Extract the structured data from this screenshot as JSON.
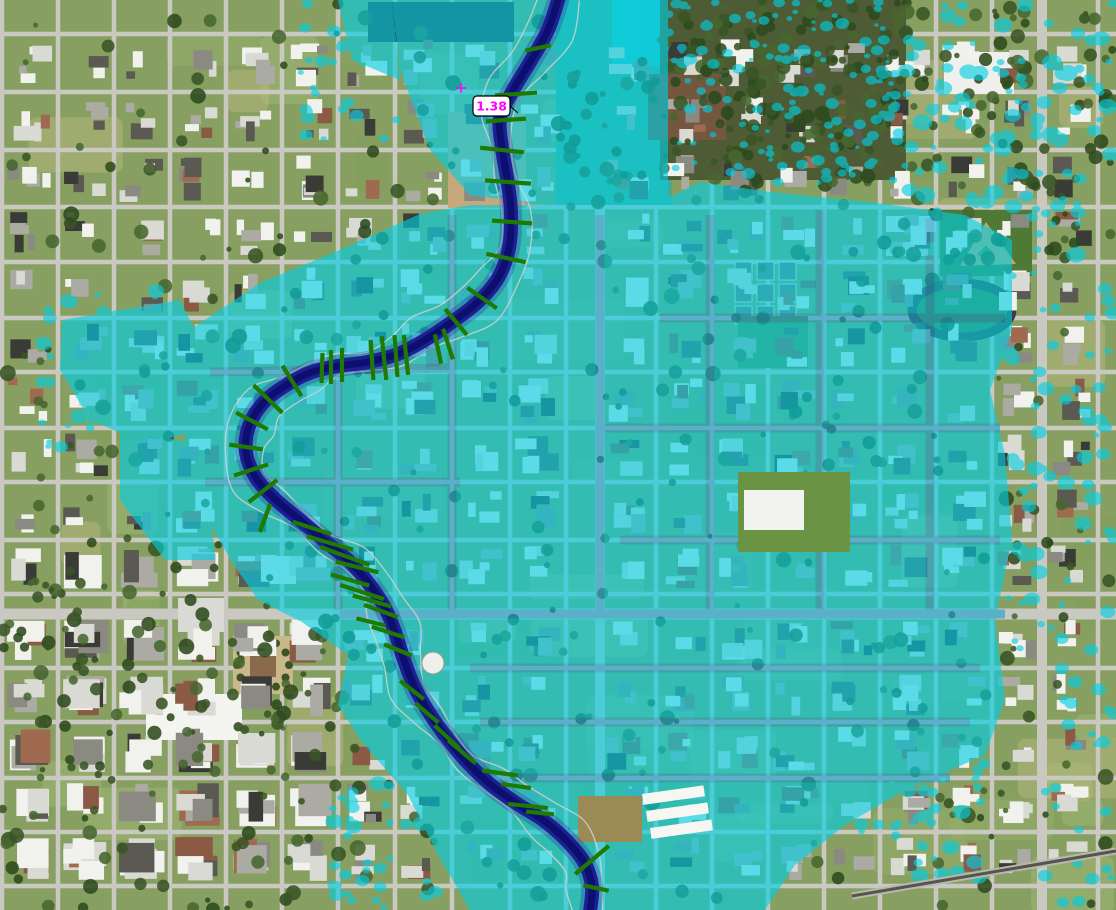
{
  "map": {
    "type": "flood-inundation-aerial-map",
    "station_label": {
      "text": "1.38",
      "x": 473,
      "y": 96,
      "w": 37,
      "h": 20,
      "text_color": "#FF00FF",
      "box_fill": "#FFFFFF",
      "box_border": "#000000"
    },
    "marker_cross": {
      "x": 461,
      "y": 88,
      "color": "#FF00FF"
    },
    "colors": {
      "flood": "#00CFE4",
      "flood_opacity": 0.62,
      "flood_street": "#17A0CE",
      "channel_outer": "#1D1F92",
      "channel_core": "#0D0F6E",
      "channel_glow": "#2A2AA0",
      "cross_section": "#1E7A02",
      "bank_line": "#D2D2CC",
      "ground": "#87A061",
      "street": "#C9C9C2",
      "railroad": "#55554D"
    },
    "river_path": [
      [
        560,
        -6
      ],
      [
        548,
        30
      ],
      [
        530,
        62
      ],
      [
        512,
        92
      ],
      [
        500,
        118
      ],
      [
        502,
        148
      ],
      [
        507,
        178
      ],
      [
        511,
        212
      ],
      [
        509,
        248
      ],
      [
        498,
        278
      ],
      [
        478,
        302
      ],
      [
        452,
        322
      ],
      [
        425,
        340
      ],
      [
        398,
        354
      ],
      [
        368,
        362
      ],
      [
        338,
        366
      ],
      [
        312,
        372
      ],
      [
        288,
        384
      ],
      [
        264,
        402
      ],
      [
        249,
        426
      ],
      [
        246,
        452
      ],
      [
        256,
        478
      ],
      [
        276,
        500
      ],
      [
        300,
        520
      ],
      [
        326,
        542
      ],
      [
        350,
        562
      ],
      [
        370,
        585
      ],
      [
        385,
        608
      ],
      [
        395,
        632
      ],
      [
        404,
        660
      ],
      [
        415,
        688
      ],
      [
        430,
        714
      ],
      [
        447,
        738
      ],
      [
        467,
        762
      ],
      [
        490,
        784
      ],
      [
        516,
        803
      ],
      [
        543,
        820
      ],
      [
        566,
        840
      ],
      [
        584,
        862
      ],
      [
        592,
        886
      ],
      [
        590,
        912
      ]
    ],
    "cross_sections": [
      [
        538,
        48,
        -12,
        26
      ],
      [
        516,
        94,
        -4,
        42
      ],
      [
        506,
        120,
        -4,
        40
      ],
      [
        502,
        150,
        6,
        44
      ],
      [
        508,
        182,
        4,
        46
      ],
      [
        512,
        222,
        4,
        40
      ],
      [
        506,
        258,
        12,
        40
      ],
      [
        482,
        298,
        35,
        36
      ],
      [
        456,
        322,
        50,
        34
      ],
      [
        448,
        344,
        72,
        32
      ],
      [
        438,
        349,
        78,
        30
      ],
      [
        406,
        355,
        84,
        40
      ],
      [
        396,
        356,
        86,
        42
      ],
      [
        384,
        358,
        84,
        44
      ],
      [
        372,
        360,
        86,
        40
      ],
      [
        342,
        365,
        90,
        34
      ],
      [
        331,
        367,
        90,
        34
      ],
      [
        322,
        368,
        92,
        30
      ],
      [
        292,
        381,
        58,
        36
      ],
      [
        268,
        399,
        44,
        40
      ],
      [
        252,
        421,
        28,
        36
      ],
      [
        246,
        447,
        8,
        34
      ],
      [
        251,
        470,
        -18,
        36
      ],
      [
        263,
        491,
        -38,
        36
      ],
      [
        265,
        518,
        -70,
        30
      ],
      [
        312,
        528,
        18,
        40
      ],
      [
        330,
        543,
        16,
        48
      ],
      [
        345,
        556,
        20,
        52
      ],
      [
        357,
        567,
        14,
        44
      ],
      [
        350,
        580,
        16,
        40
      ],
      [
        362,
        592,
        18,
        46
      ],
      [
        372,
        601,
        16,
        40
      ],
      [
        381,
        611,
        20,
        36
      ],
      [
        371,
        622,
        14,
        30
      ],
      [
        388,
        632,
        18,
        34
      ],
      [
        398,
        650,
        22,
        30
      ],
      [
        412,
        690,
        38,
        30
      ],
      [
        427,
        713,
        40,
        30
      ],
      [
        447,
        737,
        43,
        34
      ],
      [
        462,
        752,
        40,
        36
      ],
      [
        500,
        773,
        8,
        36
      ],
      [
        516,
        786,
        8,
        30
      ],
      [
        528,
        806,
        6,
        40
      ],
      [
        540,
        813,
        6,
        28
      ],
      [
        592,
        860,
        -40,
        44
      ],
      [
        596,
        888,
        12,
        26
      ]
    ],
    "flood_zones": [
      {
        "name": "upper-floodway",
        "points": [
          [
            392,
            0
          ],
          [
            668,
            0
          ],
          [
            668,
            198
          ],
          [
            580,
            210
          ],
          [
            470,
            195
          ],
          [
            430,
            150
          ],
          [
            400,
            70
          ]
        ]
      },
      {
        "name": "main-floodplain",
        "points": [
          [
            180,
            395
          ],
          [
            190,
            330
          ],
          [
            260,
            283
          ],
          [
            335,
            252
          ],
          [
            420,
            214
          ],
          [
            470,
            205
          ],
          [
            560,
            205
          ],
          [
            668,
            198
          ],
          [
            700,
            182
          ],
          [
            770,
            192
          ],
          [
            870,
            202
          ],
          [
            965,
            215
          ],
          [
            1012,
            240
          ],
          [
            1012,
            330
          ],
          [
            990,
            390
          ],
          [
            1005,
            455
          ],
          [
            1012,
            540
          ],
          [
            995,
            620
          ],
          [
            1005,
            700
          ],
          [
            985,
            755
          ],
          [
            905,
            790
          ],
          [
            845,
            825
          ],
          [
            795,
            865
          ],
          [
            765,
            910
          ],
          [
            470,
            910
          ],
          [
            438,
            855
          ],
          [
            408,
            795
          ],
          [
            362,
            742
          ],
          [
            338,
            705
          ],
          [
            348,
            655
          ],
          [
            302,
            622
          ],
          [
            258,
            600
          ],
          [
            232,
            562
          ],
          [
            208,
            520
          ],
          [
            188,
            465
          ]
        ]
      },
      {
        "name": "west-pocket",
        "points": [
          [
            62,
            320
          ],
          [
            180,
            300
          ],
          [
            200,
            340
          ],
          [
            195,
            430
          ],
          [
            150,
            445
          ],
          [
            90,
            420
          ],
          [
            60,
            370
          ]
        ]
      },
      {
        "name": "west-lower-pocket",
        "points": [
          [
            120,
            430
          ],
          [
            205,
            445
          ],
          [
            215,
            560
          ],
          [
            165,
            560
          ],
          [
            120,
            500
          ]
        ]
      },
      {
        "name": "north-west-strip",
        "points": [
          [
            338,
            0
          ],
          [
            392,
            0
          ],
          [
            400,
            80
          ],
          [
            352,
            60
          ]
        ]
      }
    ],
    "flooded_street_streaks": [
      [
        340,
        614,
        1005,
        614
      ],
      [
        452,
        215,
        452,
        610
      ],
      [
        210,
        372,
        450,
        368
      ],
      [
        338,
        380,
        338,
        610
      ],
      [
        205,
        482,
        460,
        482
      ],
      [
        600,
        215,
        600,
        612
      ],
      [
        710,
        215,
        710,
        610
      ],
      [
        820,
        210,
        820,
        612
      ],
      [
        930,
        218,
        930,
        612
      ],
      [
        660,
        318,
        1005,
        318
      ],
      [
        600,
        428,
        1000,
        428
      ],
      [
        620,
        540,
        1000,
        540
      ],
      [
        470,
        668,
        980,
        668
      ],
      [
        480,
        722,
        970,
        722
      ],
      [
        500,
        778,
        950,
        778
      ]
    ],
    "flood_speckle_regions": [
      {
        "x": 660,
        "y": 0,
        "w": 250,
        "h": 185,
        "count": 150,
        "min": 2,
        "max": 7
      },
      {
        "x": 905,
        "y": 0,
        "w": 211,
        "h": 255,
        "count": 110,
        "min": 3,
        "max": 10
      },
      {
        "x": 1005,
        "y": 255,
        "w": 111,
        "h": 400,
        "count": 60,
        "min": 3,
        "max": 9
      },
      {
        "x": 855,
        "y": 740,
        "w": 130,
        "h": 140,
        "count": 45,
        "min": 3,
        "max": 9
      },
      {
        "x": 300,
        "y": 0,
        "w": 100,
        "h": 140,
        "count": 30,
        "min": 3,
        "max": 8
      },
      {
        "x": 40,
        "y": 280,
        "w": 150,
        "h": 170,
        "count": 40,
        "min": 3,
        "max": 9
      },
      {
        "x": 330,
        "y": 760,
        "w": 110,
        "h": 150,
        "count": 40,
        "min": 3,
        "max": 9
      },
      {
        "x": 1040,
        "y": 660,
        "w": 76,
        "h": 250,
        "count": 25,
        "min": 3,
        "max": 8
      }
    ],
    "streets": {
      "vertical": [
        2,
        58,
        114,
        170,
        226,
        282,
        338,
        395,
        452,
        510,
        566,
        600,
        656,
        712,
        768,
        824,
        880,
        936,
        992,
        1042,
        1098
      ],
      "horizontal": [
        34,
        92,
        150,
        207,
        262,
        318,
        372,
        428,
        482,
        540,
        594,
        614,
        668,
        722,
        778,
        832,
        886
      ],
      "major_vertical": [
        600,
        1042
      ],
      "major_horizontal": [
        614
      ]
    },
    "landmarks_under": [
      {
        "name": "park-field",
        "kind": "rect",
        "x": 556,
        "y": 0,
        "w": 116,
        "h": 205,
        "fill": "#49A88E"
      },
      {
        "name": "pond",
        "kind": "rect",
        "x": 612,
        "y": 0,
        "w": 148,
        "h": 66,
        "fill": "#2CC4C4"
      },
      {
        "name": "woods",
        "kind": "rect",
        "x": 660,
        "y": 0,
        "w": 246,
        "h": 180,
        "fill": "#4E5C36"
      },
      {
        "name": "construction-dirt",
        "kind": "rect",
        "x": 448,
        "y": 112,
        "w": 78,
        "h": 96,
        "fill": "#C6A87A"
      },
      {
        "name": "dark-roof-building",
        "kind": "rect",
        "x": 368,
        "y": 2,
        "w": 146,
        "h": 40,
        "fill": "#35373B"
      },
      {
        "name": "church-complex-roof",
        "kind": "rect",
        "x": 648,
        "y": 74,
        "w": 78,
        "h": 66,
        "fill": "#73573F"
      },
      {
        "name": "apartment-rows",
        "kind": "grid3x3",
        "x": 735,
        "y": 262,
        "w": 17,
        "h": 18,
        "gapx": 22,
        "gapy": 22,
        "fill": "#73736B"
      },
      {
        "name": "open-field",
        "kind": "rect",
        "x": 738,
        "y": 316,
        "w": 70,
        "h": 52,
        "fill": "#5C8A3C"
      },
      {
        "name": "school-building-1",
        "kind": "rect",
        "x": 886,
        "y": 216,
        "w": 50,
        "h": 16,
        "fill": "#E8E8E4"
      },
      {
        "name": "school-building-2",
        "kind": "rect",
        "x": 886,
        "y": 242,
        "w": 42,
        "h": 14,
        "fill": "#D8D8D2"
      },
      {
        "name": "white-building-topright",
        "kind": "rect",
        "x": 944,
        "y": 52,
        "w": 70,
        "h": 42,
        "fill": "#EFEFEB"
      },
      {
        "name": "ballfield",
        "kind": "ballfield",
        "x": 940,
        "y": 210,
        "w": 92,
        "h": 66
      },
      {
        "name": "track",
        "kind": "track",
        "cx": 962,
        "cy": 310,
        "rx": 50,
        "ry": 27
      },
      {
        "name": "courthouse-square",
        "kind": "plaza",
        "x": 233,
        "y": 636,
        "w": 60,
        "h": 58
      },
      {
        "name": "warehouse-large",
        "kind": "rect",
        "x": 146,
        "y": 694,
        "w": 96,
        "h": 46,
        "fill": "#F4F4F0"
      },
      {
        "name": "building-a",
        "kind": "rect",
        "x": 238,
        "y": 556,
        "w": 58,
        "h": 28,
        "fill": "#EDEDE9"
      },
      {
        "name": "building-b",
        "kind": "rect",
        "x": 178,
        "y": 598,
        "w": 46,
        "h": 34,
        "fill": "#DADAD4"
      }
    ],
    "landmarks_over": [
      {
        "name": "church-lawn",
        "kind": "rect",
        "x": 738,
        "y": 472,
        "w": 112,
        "h": 80,
        "fill": "#6A9444"
      },
      {
        "name": "church-white",
        "kind": "rect",
        "x": 744,
        "y": 490,
        "w": 60,
        "h": 40,
        "fill": "#F2F2EE"
      },
      {
        "name": "tan-field",
        "kind": "rect",
        "x": 578,
        "y": 796,
        "w": 64,
        "h": 46,
        "fill": "#9A8A55"
      },
      {
        "name": "warehouse-bar-1",
        "kind": "rrect",
        "x": 642,
        "y": 794,
        "w": 62,
        "h": 11,
        "rot": -8,
        "fill": "#F6F6F2"
      },
      {
        "name": "warehouse-bar-2",
        "kind": "rrect",
        "x": 646,
        "y": 811,
        "w": 62,
        "h": 11,
        "rot": -8,
        "fill": "#F6F6F2"
      },
      {
        "name": "warehouse-bar-3",
        "kind": "rrect",
        "x": 650,
        "y": 828,
        "w": 62,
        "h": 11,
        "rot": -8,
        "fill": "#F6F6F2"
      },
      {
        "name": "storage-tank",
        "kind": "circle",
        "cx": 433,
        "cy": 663,
        "r": 11,
        "fill": "#EFEFEA"
      },
      {
        "name": "railroad",
        "kind": "line",
        "x1": 852,
        "y1": 896,
        "x2": 1116,
        "y2": 851
      }
    ]
  }
}
